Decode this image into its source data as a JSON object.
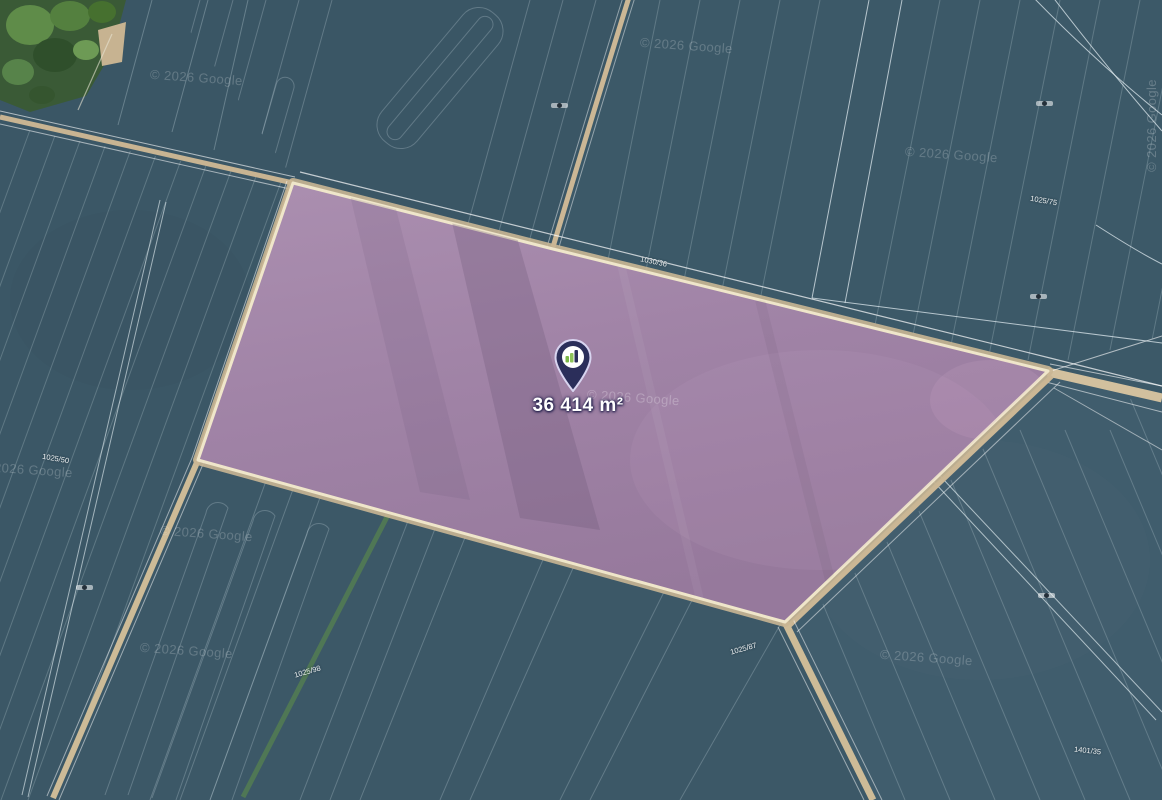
{
  "map": {
    "provider_watermark": "© 2026 Google",
    "marker": {
      "icon": "location-pin-chart-logo",
      "area_label": "36 414 m²",
      "pin_color": "#2b2e5a"
    },
    "parcel": {
      "highlight_color": "#9d80a4",
      "border_color": "#efe6ca"
    },
    "cadastral_labels": [
      {
        "text": "1030/36"
      },
      {
        "text": "1025/75"
      },
      {
        "text": "1025/50"
      },
      {
        "text": "1025/98"
      },
      {
        "text": "1025/87"
      },
      {
        "text": "1401/35"
      }
    ],
    "micro_label_icon": "tiny-parcel-marker"
  }
}
